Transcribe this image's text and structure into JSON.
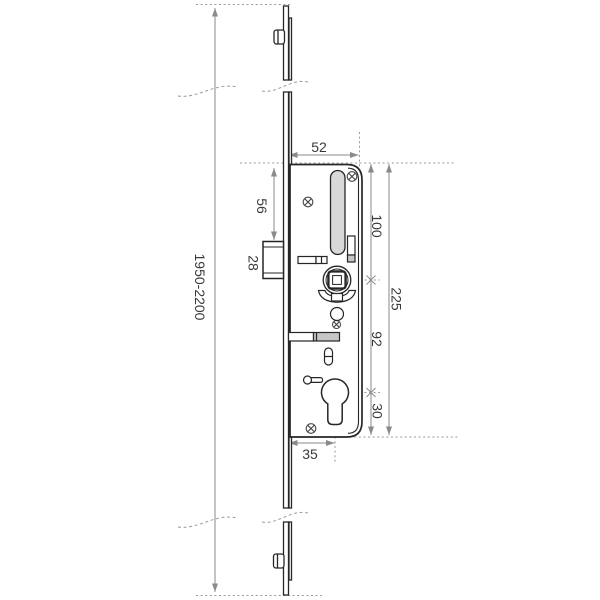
{
  "diagram": {
    "kind": "technical-dimension-drawing",
    "subject": "multipoint-door-lock-gearbox",
    "colors": {
      "background": "#ffffff",
      "outline": "#262626",
      "dimension_line": "#8a8a8a",
      "dotted_line": "#9a9a9a",
      "slot_fill": "#d8d8d8",
      "bolt_fill": "#c6c6c6",
      "label_text": "#3a3a3a"
    },
    "labels": {
      "case_width": "52",
      "top_to_latch": "56",
      "latch_height": "28",
      "top_to_spindle": "100",
      "case_height": "225",
      "spindle_to_cylinder": "92",
      "cylinder_to_bottom": "30",
      "backset": "35",
      "overall_length": "1950-2200"
    }
  }
}
